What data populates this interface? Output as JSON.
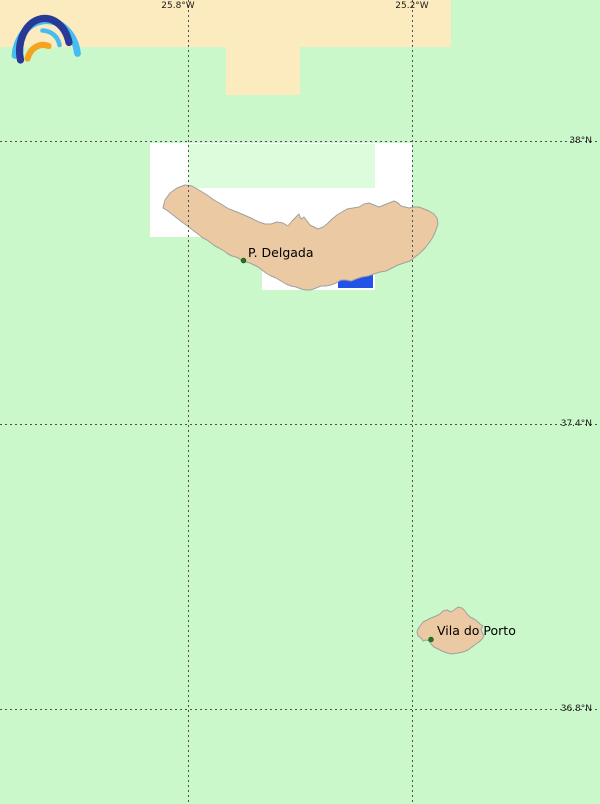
{
  "map": {
    "grid_labels": {
      "lon": [
        {
          "text": "25.8°W"
        },
        {
          "text": "25.2°W"
        }
      ],
      "lat": [
        {
          "text": "38°N"
        },
        {
          "text": "37.4°N"
        },
        {
          "text": "36.8°N"
        }
      ]
    },
    "places": [
      {
        "label": "P. Delgada"
      },
      {
        "label": "Vila do Porto"
      }
    ],
    "icons": {
      "logo": "opencpn-rainbow-logo"
    },
    "colors": {
      "sea_background_green": "#CBF8CB",
      "coverage_inset_green": "#DCFCDC",
      "no_coverage_cream": "#FCEBBE",
      "detail_coverage_white": "#FFFFFF",
      "land_fill": "#EBC9A2",
      "land_outline": "#A0A0A0",
      "shallow_water_blue": "#2253E6",
      "town_dot_green": "#1B7A1B",
      "grid_line_gray": "#4F4F4F",
      "logo_light_blue": "#45BCF2",
      "logo_dark_blue": "#283A96",
      "logo_orange": "#F6A41F"
    }
  }
}
